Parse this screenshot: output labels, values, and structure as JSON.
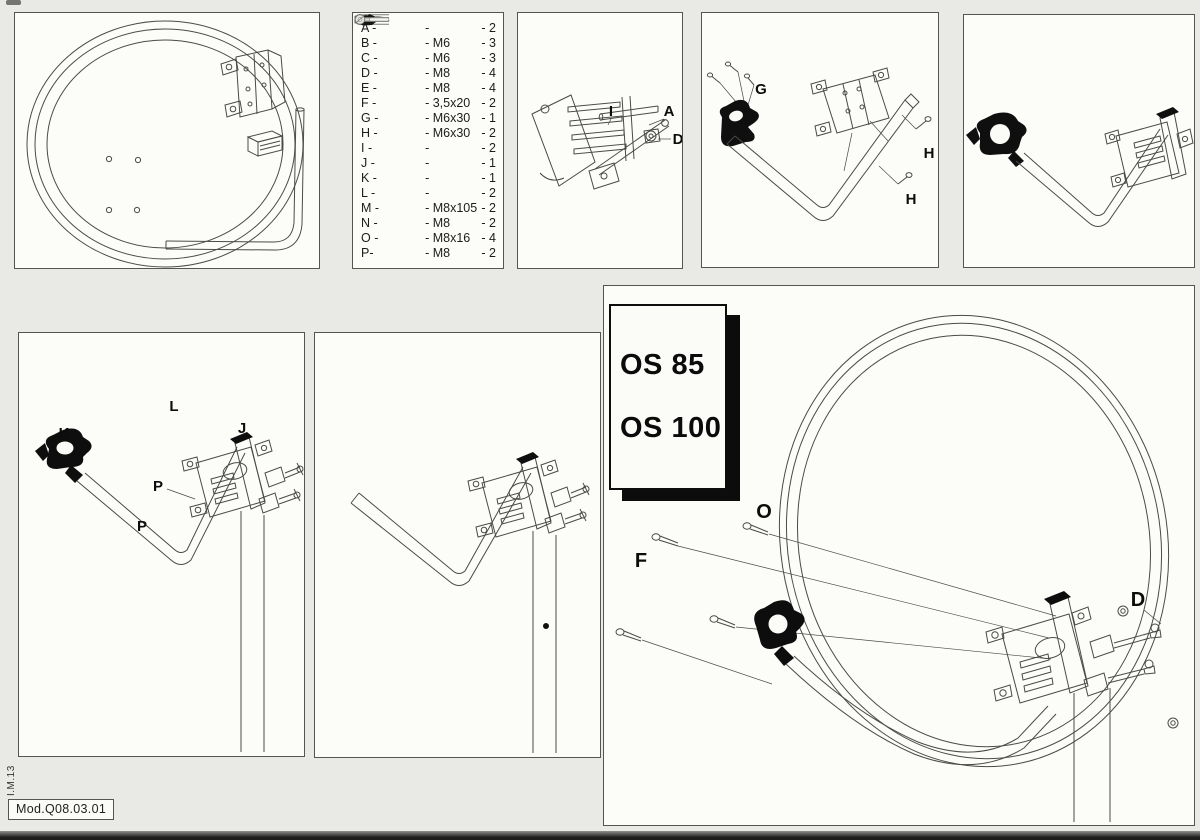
{
  "title_box": {
    "model_1": "OS 85",
    "model_2": "OS 100"
  },
  "footer": {
    "doc_code": "Mod.Q08.03.01",
    "margin_code": "I.M.13"
  },
  "colors": {
    "paper": "#e9e9e6",
    "panel": "#fcfcf9",
    "ink": "#4a4a48",
    "part_black": "#0d0d0d"
  },
  "parts_list": {
    "rows": [
      {
        "letter": "A -",
        "icon": "saddle-clamp-icon",
        "size": "-",
        "qty": "- 2"
      },
      {
        "letter": "B -",
        "icon": "",
        "size": "- M6",
        "qty": "- 3"
      },
      {
        "letter": "C -",
        "icon": "washer-icon",
        "size": "- M6",
        "qty": "- 3"
      },
      {
        "letter": "D -",
        "icon": "",
        "size": "- M8",
        "qty": "- 4"
      },
      {
        "letter": "E -",
        "icon": "washer-icon",
        "size": "- M8",
        "qty": "- 4"
      },
      {
        "letter": "F -",
        "icon": "screw-icon",
        "size": "- 3,5x20",
        "qty": "- 2"
      },
      {
        "letter": "G -",
        "icon": "bolt-icon",
        "size": "- M6x30",
        "qty": "- 1"
      },
      {
        "letter": "H -",
        "icon": "bolt-icon",
        "size": "- M6x30",
        "qty": "- 2"
      },
      {
        "letter": "I -",
        "icon": "u-bolt-icon",
        "size": "-",
        "qty": "- 2"
      },
      {
        "letter": "J -",
        "icon": "clamp-icon",
        "size": "-",
        "qty": "- 1"
      },
      {
        "letter": "K -",
        "icon": "clamp-icon",
        "size": "-",
        "qty": "- 1"
      },
      {
        "letter": "L -",
        "icon": "tube-icon",
        "size": "-",
        "qty": "- 2"
      },
      {
        "letter": "M -",
        "icon": "long-bolt-icon",
        "size": "- M8x105",
        "qty": "- 2"
      },
      {
        "letter": "N -",
        "icon": "",
        "size": "- M8",
        "qty": "- 2"
      },
      {
        "letter": "O -",
        "icon": "short-bolt-icon",
        "size": "- M8x16",
        "qty": "- 4"
      },
      {
        "letter": "P-",
        "icon": "lock-washer-icon",
        "size": "- M8",
        "qty": "- 2"
      }
    ]
  },
  "diagram_labels": {
    "step1": {
      "i": "I",
      "a": "A",
      "d": "D"
    },
    "step2": {
      "g": "G",
      "h_upper": "H",
      "h_lower": "H"
    },
    "step4": {
      "k": "K",
      "l": "L",
      "j": "J",
      "p_upper": "P",
      "p_lower": "P"
    },
    "final": {
      "o": "O",
      "f": "F",
      "d": "D"
    }
  }
}
